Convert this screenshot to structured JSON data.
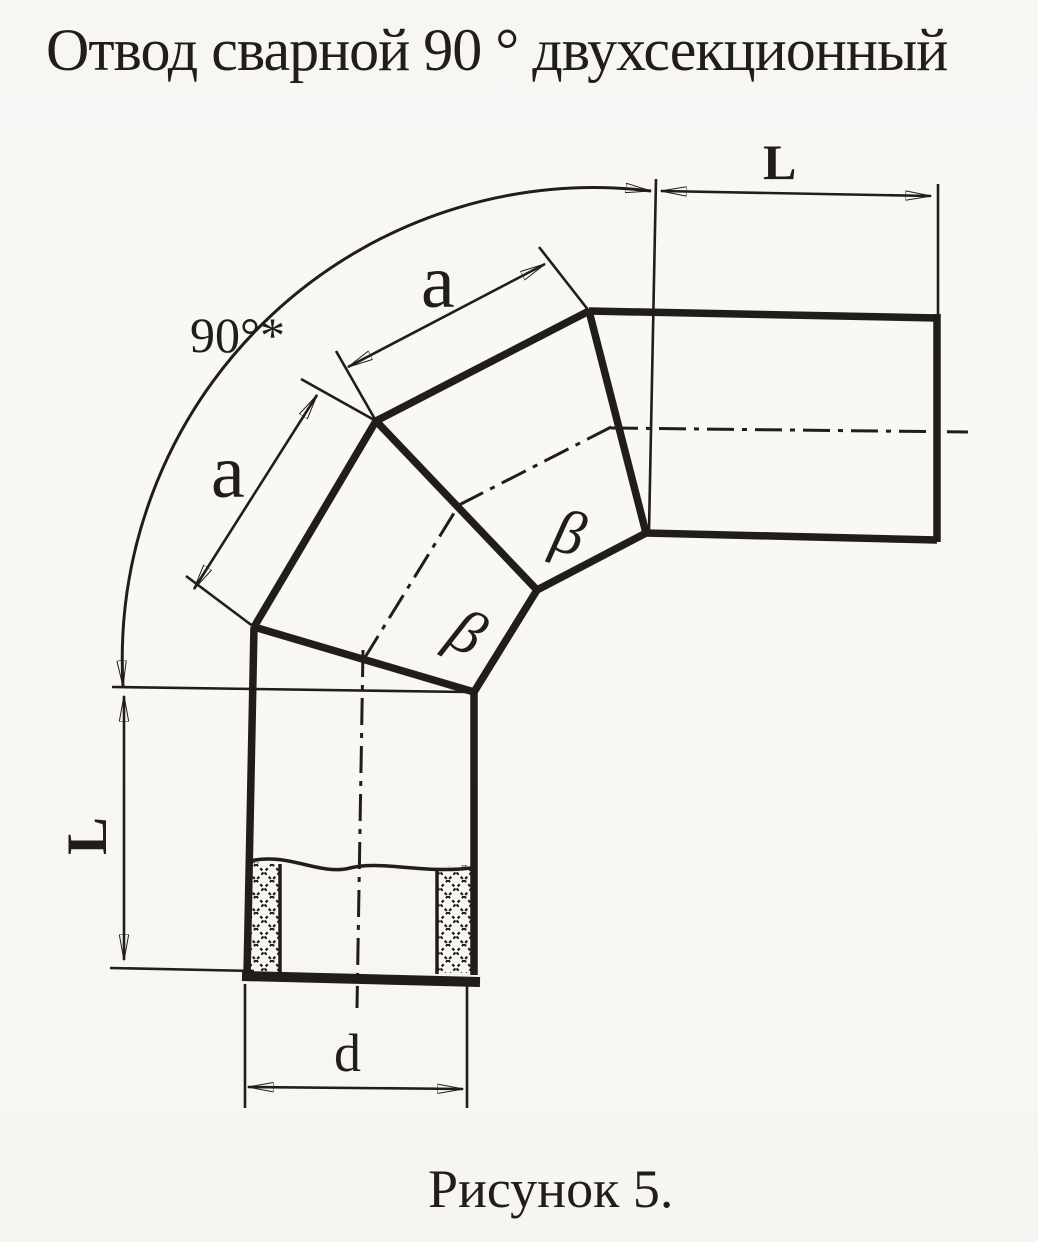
{
  "title": "Отвод сварной 90 ° двухсекционный",
  "caption": "Рисунок 5.",
  "drawing": {
    "angle_label": "90°*",
    "L_top": "L",
    "L_left": "L",
    "a_upper": "a",
    "a_lower": "a",
    "d_label": "d",
    "beta_upper": "β",
    "beta_lower": "β"
  },
  "colors": {
    "ink": "#201d1a",
    "paper": "#f7f6f3"
  }
}
